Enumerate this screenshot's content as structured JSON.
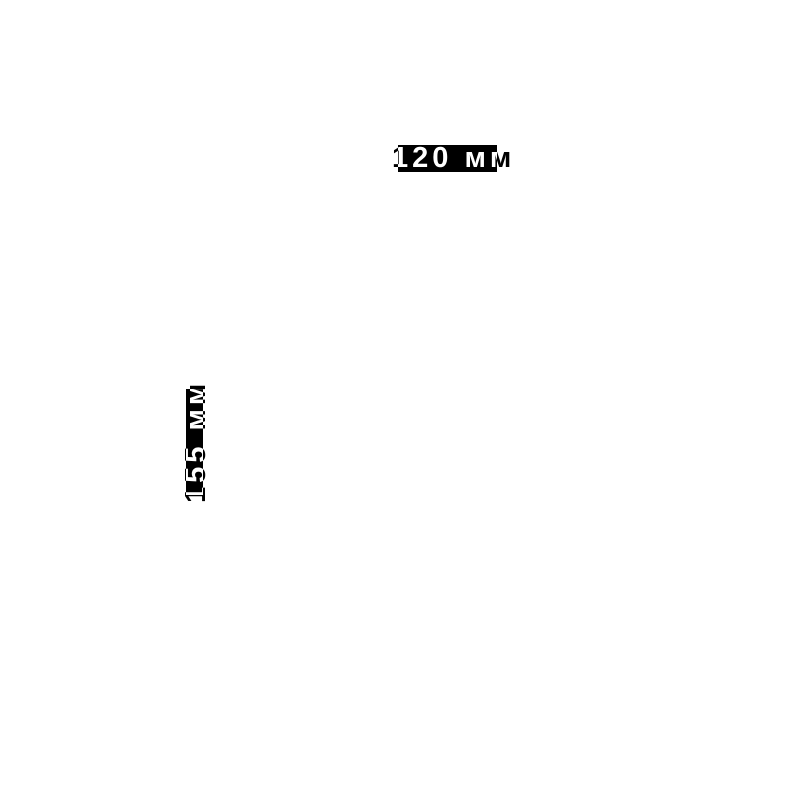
{
  "page": {
    "type": "dimension-drawing",
    "background": "#ffffff"
  },
  "colors": {
    "background": "#ffffff",
    "badge": "#000000",
    "label-text": "#ffffff"
  },
  "dimensions": {
    "width": {
      "label": "120 мм",
      "value": 120,
      "unit": "мм",
      "orientation": "horizontal"
    },
    "height": {
      "label": "155 мм",
      "value": 155,
      "unit": "мм",
      "orientation": "vertical"
    }
  }
}
